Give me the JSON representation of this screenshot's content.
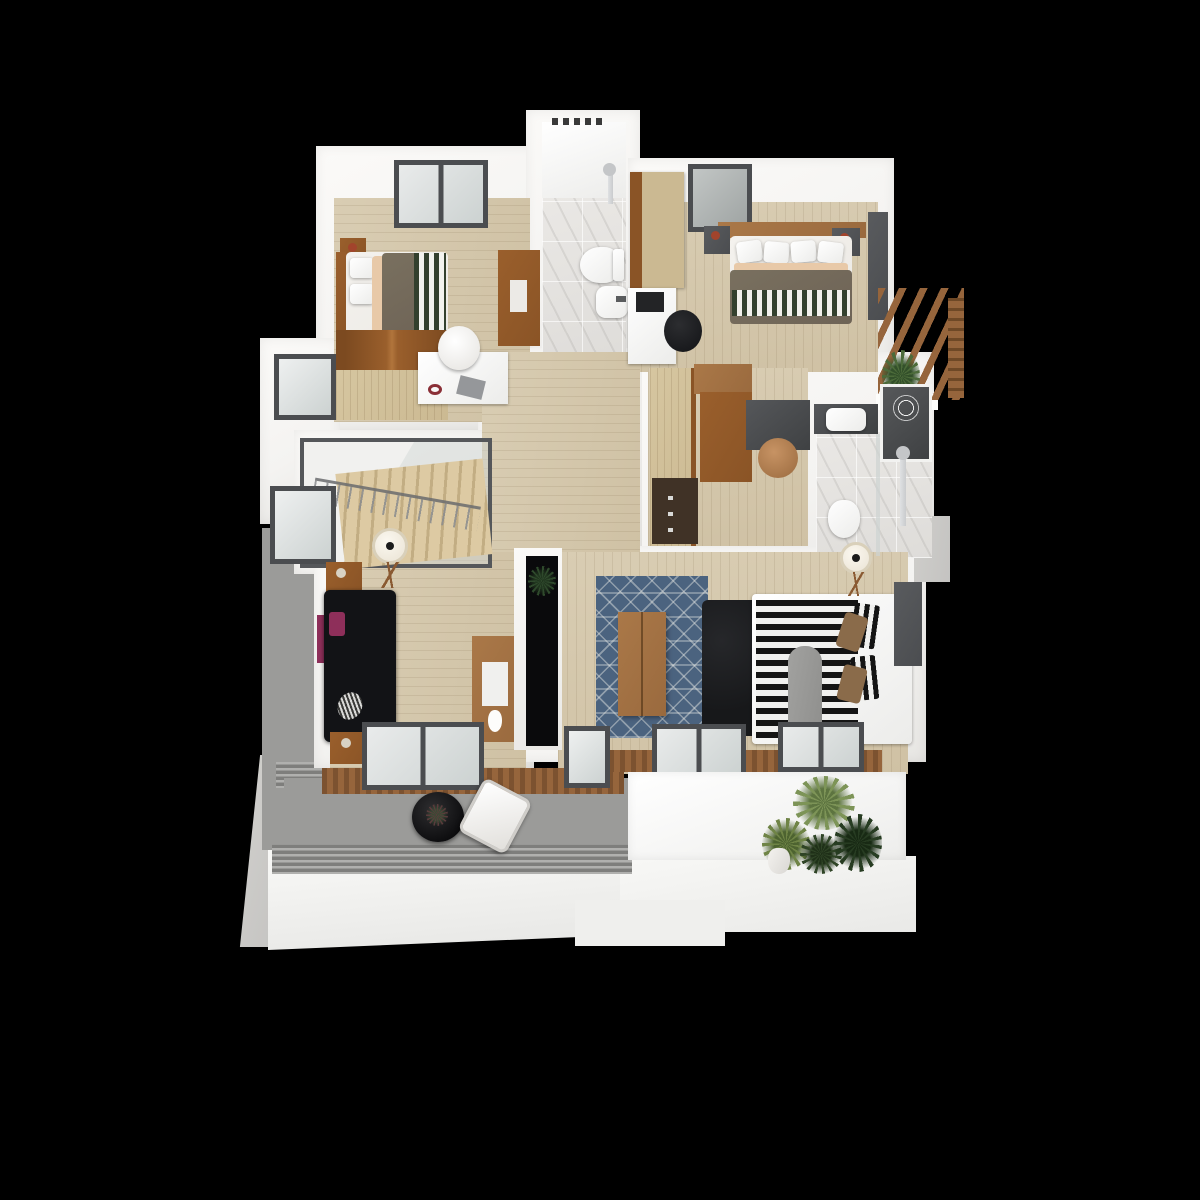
{
  "scene": {
    "description": "3D rendered top-down floor plan of an apartment upper storey on a black background",
    "background": "#000000",
    "palette": {
      "bg": "#000000",
      "wall": "#f4f3f1",
      "wallShade": "#e7e6e3",
      "woodFloor": "#d9cdb3",
      "woodFloorDark": "#cfc1a4",
      "marble": "#eae8e5",
      "balcony": "#9b9b99",
      "deck": "#96653c",
      "deckDark": "#7c5230",
      "facade": "#f2f1ef",
      "concrete": "#c4c3c1",
      "frame": "#4b4d50",
      "glass": "#ccd2d1",
      "furnWood": "#9a6a3e",
      "furnOrange": "#8a5426",
      "furnLight": "#cbb992",
      "bedBrown": "#6e6356",
      "mattress": "#ece9e4",
      "stripeGreen": "#33402e",
      "sofa": "#121316",
      "rug": "#4b637f",
      "duvetDark": "#151515",
      "duvetWhite": "#f1f1ef",
      "bench": "#17181a",
      "lamp": "#efe9dc",
      "plant": "#3d5a33",
      "plantDark": "#283d24",
      "plantLight": "#7d9457",
      "pillowBrown": "#8a6b4a",
      "blanketGrey": "#8e8e8c",
      "tvBlack": "#0a0a0c",
      "darkDesk": "#3f4143",
      "magenta": "#8e2f5a",
      "silver": "#c9cbcd"
    },
    "rooms": [
      {
        "name": "bedroom-top-left",
        "furniture": [
          "double-bed-brown-duvet",
          "green-striped-throw",
          "nightstand",
          "white-desk",
          "laptop",
          "headphones",
          "shell-chair",
          "wood-dresser",
          "low-gabled-wardrobe",
          "two-pane-window"
        ]
      },
      {
        "name": "bathroom-top",
        "furniture": [
          "walk-in-shower",
          "shower-head",
          "toilet",
          "washbasin",
          "marble-tile-floor",
          "towel-rail"
        ]
      },
      {
        "name": "bedroom-top-right",
        "furniture": [
          "double-bed-brown-duvet",
          "green-striped-throw",
          "two-nightstands",
          "table-lamps",
          "white-desk",
          "black-office-chair",
          "wardrobe",
          "dark-window",
          "dark-wall-panel"
        ]
      },
      {
        "name": "pergola-balcony-top-right",
        "furniture": [
          "wood-slat-pergola",
          "plant"
        ]
      },
      {
        "name": "dressing-study",
        "furniture": [
          "light-wood-closet",
          "orange-wardrobe",
          "drawer-unit",
          "dark-desk",
          "wood-chair"
        ]
      },
      {
        "name": "bathroom-ensuite",
        "furniture": [
          "dark-vanity-counter",
          "basin",
          "toilet",
          "shower-column",
          "dark-shower-tray",
          "mandala-mat",
          "marble-tile-floor"
        ]
      },
      {
        "name": "staircase",
        "furniture": [
          "glass-balustrade",
          "wood-steps",
          "railing"
        ]
      },
      {
        "name": "hallway",
        "furniture": [
          "wood-plank-floor"
        ]
      },
      {
        "name": "living-room",
        "furniture": [
          "black-sofa",
          "magenta-cushion",
          "two-side-tables",
          "tripod-floor-lamp",
          "wood-sideboard",
          "white-vase",
          "sliding-glass-door",
          "black-tv-niche",
          "plant"
        ]
      },
      {
        "name": "bedroom-bottom",
        "furniture": [
          "bed-black-white-striped-duvet",
          "grey-throw",
          "striped-pillows",
          "brown-pillows",
          "black-bench",
          "wood-coffee-table",
          "blue-patterned-rug",
          "tripod-floor-lamp",
          "three-windows",
          "dark-outdoor-unit"
        ]
      },
      {
        "name": "front-balcony",
        "furniture": [
          "round-black-table",
          "flower-pot",
          "white-armchair",
          "louvered-railing",
          "wood-deck-strip",
          "grey-carpet-floor"
        ]
      },
      {
        "name": "side-terrace-left",
        "furniture": [
          "grey-carpet-floor",
          "louver-vent"
        ]
      },
      {
        "name": "roof-terrace-right",
        "furniture": [
          "palm-plant",
          "star-plant",
          "dark-leafy-plant",
          "fern-plant",
          "white-vase"
        ]
      },
      {
        "name": "building-facade",
        "furniture": [
          "white-parapet",
          "concrete-pillar",
          "concrete-corner"
        ]
      }
    ],
    "windows_count": 8,
    "entry_windows": 2
  }
}
